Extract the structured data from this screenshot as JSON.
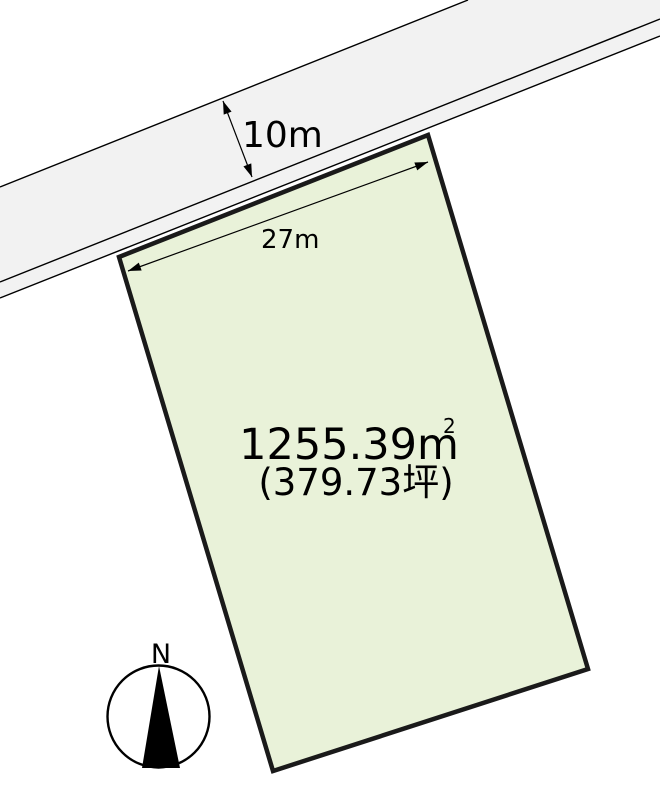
{
  "diagram": {
    "type": "land-plot-diagram",
    "labels": {
      "road_width": "10m",
      "frontage": "27m",
      "area_m2_value": "1255.39m",
      "area_m2_sup": "2",
      "area_tsubo": "(379.73坪)",
      "compass_north": "N"
    },
    "colors": {
      "background": "#ffffff",
      "road_fill": "#f2f2f2",
      "road_line": "#000000",
      "plot_fill": "#e9f2d9",
      "plot_border": "#1a1a1a",
      "text": "#000000"
    }
  }
}
